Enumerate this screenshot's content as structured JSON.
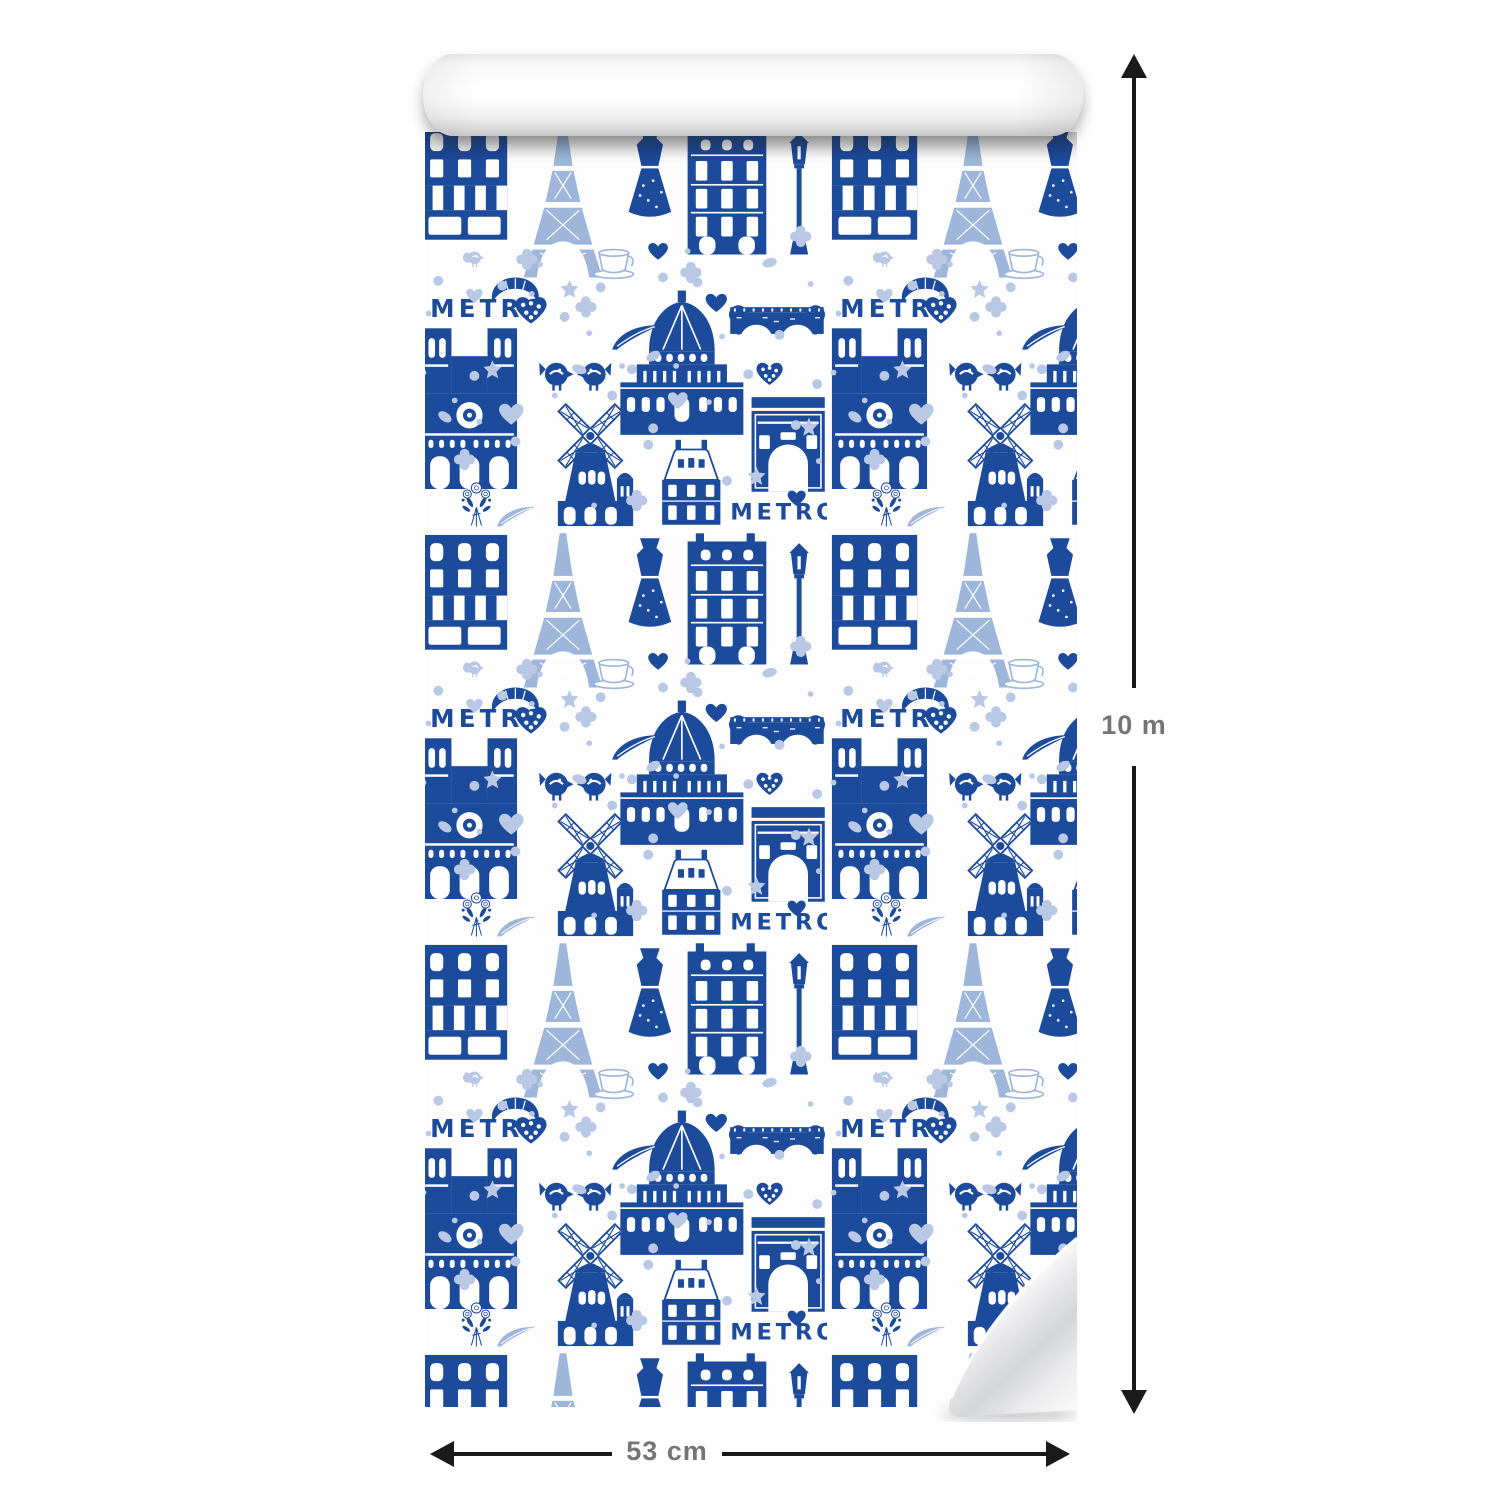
{
  "dimensions": {
    "height_label": "10 m",
    "width_label": "53 cm",
    "arrow_color": "#1a1a1a",
    "label_color": "#757575"
  },
  "wallpaper": {
    "metro_sign_text": "METRO",
    "colors": {
      "navy": "#1d4b9c",
      "light_blue": "#b9c9e5",
      "mid_blue": "#9db6da",
      "paper_white": "#fdfdfe"
    },
    "motifs": [
      "eiffel-tower-icon",
      "notre-dame-icon",
      "arc-de-triomphe-icon",
      "moulin-rouge-windmill-icon",
      "dome-church-icon",
      "paris-building-icon",
      "shop-awning-icon",
      "mansard-house-icon",
      "bridge-with-trees-icon",
      "metro-sign",
      "heart-icon",
      "dotted-heart-icon",
      "bird-icon",
      "dress-icon",
      "street-lamp-icon",
      "croissant-icon",
      "coffee-cup-icon",
      "feather-icon",
      "flower-bouquet-icon",
      "clover-icon",
      "star-icon",
      "polka-dot-icon"
    ]
  }
}
